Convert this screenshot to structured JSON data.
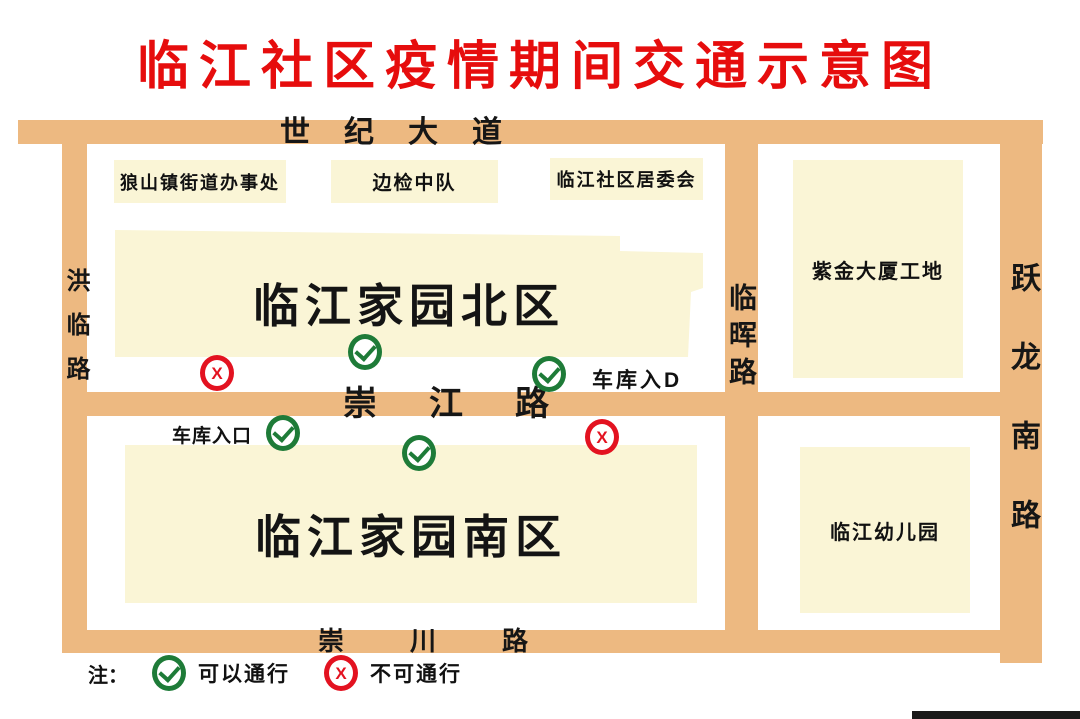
{
  "title": "临江社区疫情期间交通示意图",
  "roads": {
    "century_avenue": "世纪大道",
    "honglin_road": "洪临路",
    "linhui_road": "临晖路",
    "yuelong_south_road": "跃龙南路",
    "chongjiang_road": "崇江路",
    "chongchuan_road": "崇川路"
  },
  "blocks": {
    "langshan_street_office": "狼山镇街道办事处",
    "border_inspection_unit": "边检中队",
    "community_committee": "临江社区居委会",
    "north_district": "临江家园北区",
    "zijin_tower_site": "紫金大厦工地",
    "south_district": "临江家园南区",
    "kindergarten": "临江幼儿园"
  },
  "annotations": {
    "garage_entrance_north": "车库入D",
    "garage_entrance_south": "车库入口"
  },
  "legend": {
    "note": "注：",
    "pass_label": "可以通行",
    "no_pass_label": "不可通行"
  },
  "icons": {
    "pass_glyph": "check",
    "no_pass_glyph": "X"
  },
  "colors": {
    "road": "#edb981",
    "block": "#faf5d6",
    "title_red": "#e60d0d",
    "pass_green": "#1e7b38",
    "no_pass_red": "#e31220"
  },
  "markers": [
    {
      "type": "no_pass",
      "x": 217,
      "y": 373
    },
    {
      "type": "pass",
      "x": 365,
      "y": 352
    },
    {
      "type": "pass",
      "x": 549,
      "y": 374
    },
    {
      "type": "pass",
      "x": 283,
      "y": 433
    },
    {
      "type": "pass",
      "x": 419,
      "y": 453
    },
    {
      "type": "no_pass",
      "x": 602,
      "y": 437
    }
  ]
}
